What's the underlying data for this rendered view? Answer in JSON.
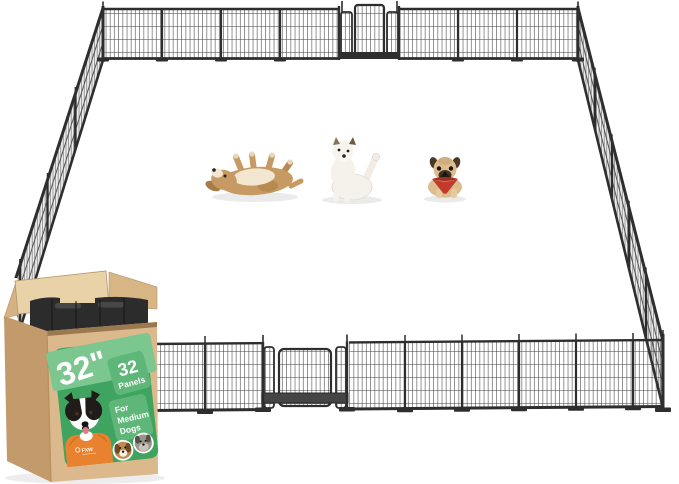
{
  "scene": {
    "type": "product-photo",
    "description": "32-panel metal dog playpen arranged as a large rectangular enclosure with three dogs inside; open retail box with green label in the foreground",
    "background": "#ffffff"
  },
  "colors": {
    "fence": "#2e2e2e",
    "fence_mesh_side": "#ededed",
    "label_green": "#3fa45f",
    "band_green": "#7cc790",
    "chip_green": "#5eb678",
    "shirt_orange": "#e8822f",
    "cardboard_front": "#dcb98c",
    "cardboard_side": "#c29a6b",
    "cardboard_flap": "#e9d2a7",
    "cardboard_flap_side": "#d8b584",
    "panel_stack": "#2c2c2c",
    "bandana_red": "#c23a2b",
    "dog_tan": "#c79a63",
    "dog_white": "#f5f2ec",
    "pug_fawn": "#dcbd8e"
  },
  "playpen": {
    "shape": "large rectangle in perspective",
    "gates": [
      "back-gate-top-center",
      "front-gate-bottom-center"
    ]
  },
  "dogs": [
    {
      "id": "rolling-dog",
      "description": "tan dog rolling on its back, legs in the air"
    },
    {
      "id": "sitting-dog",
      "description": "white puppy sitting, scratching its ear with raised hind leg"
    },
    {
      "id": "pug-dog",
      "description": "fawn pug lying down wearing a red bandana"
    }
  ],
  "box": {
    "state": "open, with stacked black fence panels inside",
    "label": {
      "size_value": "32\"",
      "size_unit": "tall",
      "panel_count": "32",
      "panel_label": "Panels",
      "audience_line1": "For",
      "audience_line2": "Medium",
      "audience_line3": "Dogs",
      "brand": "FXW",
      "photos": [
        "border-collie-in-orange-shirt-photo",
        "beagle-face-photo-icon",
        "schnauzer-face-photo-icon"
      ]
    }
  }
}
